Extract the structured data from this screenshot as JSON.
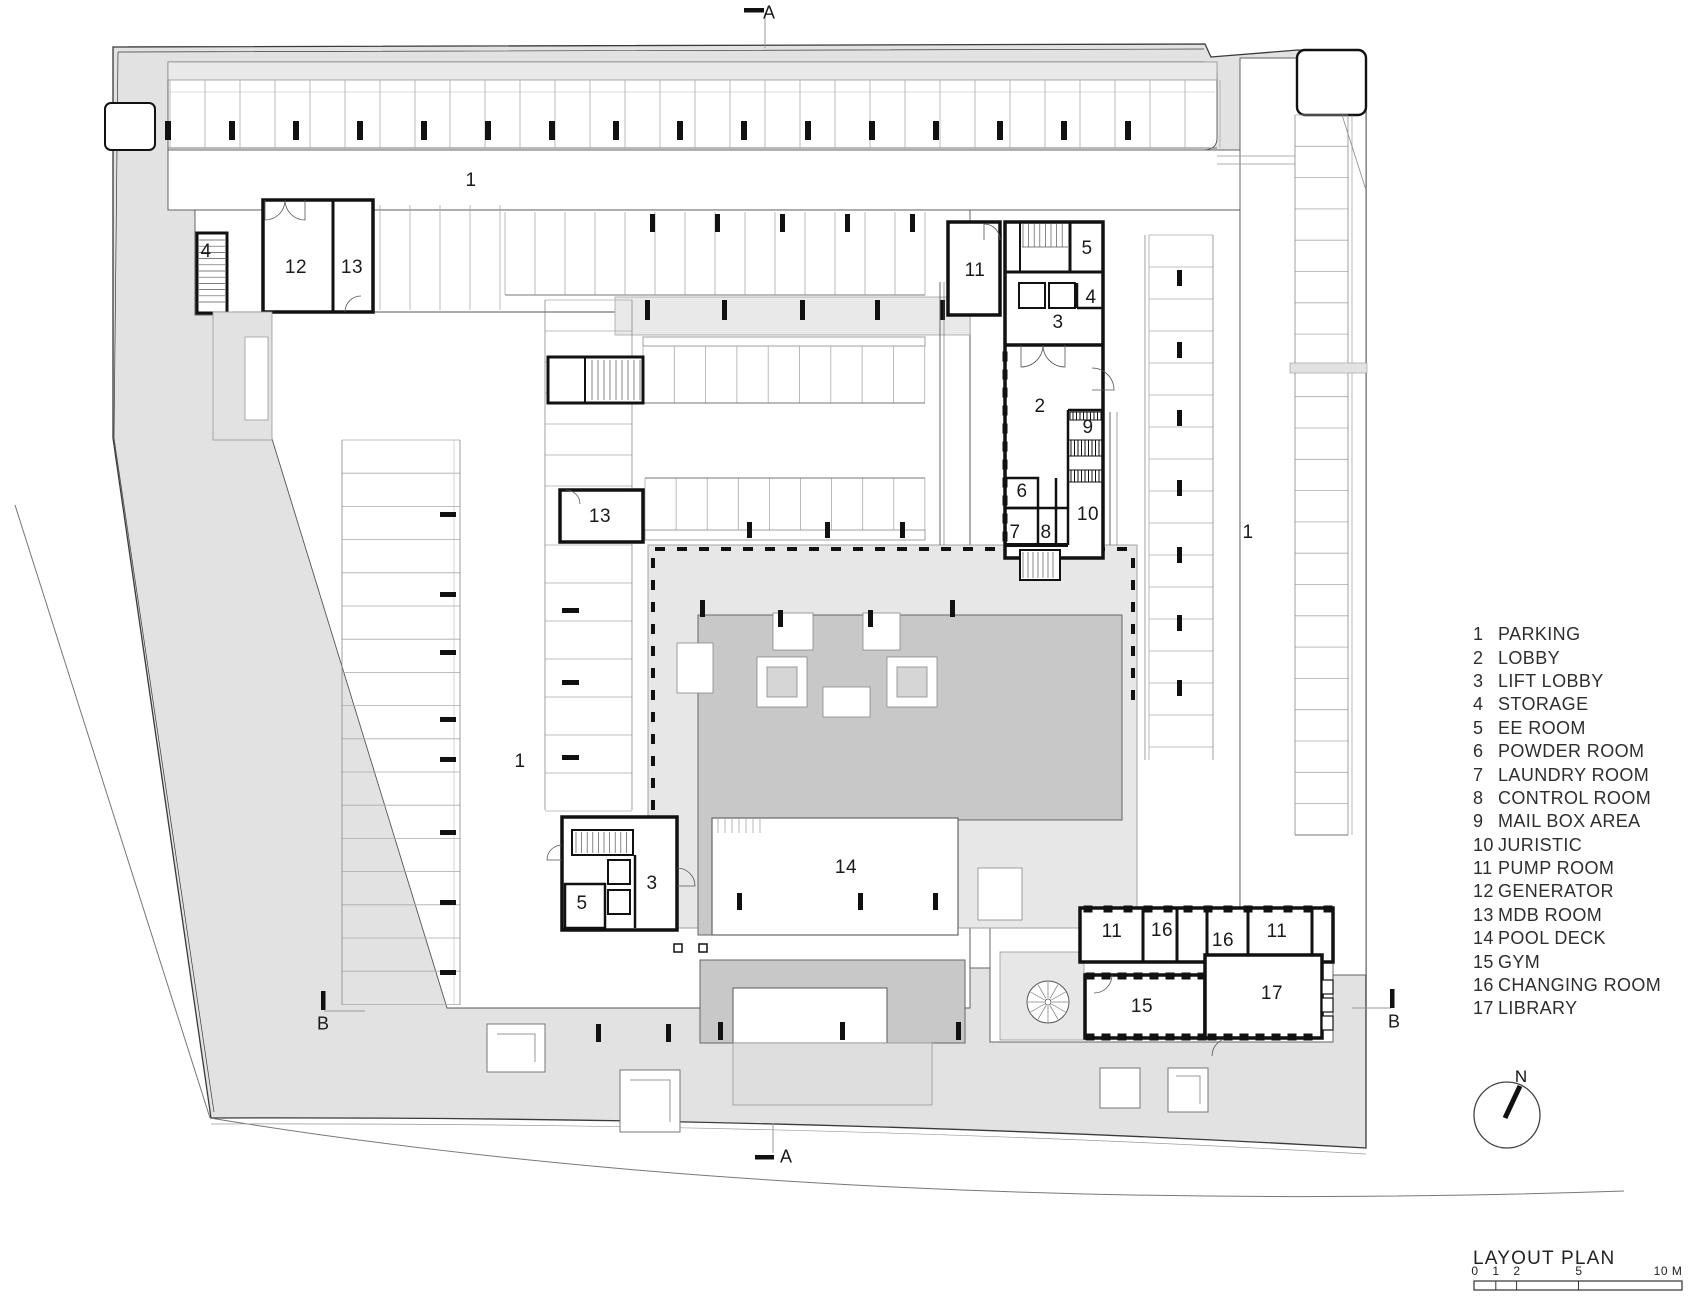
{
  "legend": {
    "items": [
      {
        "num": "1",
        "label": "PARKING"
      },
      {
        "num": "2",
        "label": "LOBBY"
      },
      {
        "num": "3",
        "label": "LIFT LOBBY"
      },
      {
        "num": "4",
        "label": "STORAGE"
      },
      {
        "num": "5",
        "label": "EE ROOM"
      },
      {
        "num": "6",
        "label": "POWDER ROOM"
      },
      {
        "num": "7",
        "label": "LAUNDRY ROOM"
      },
      {
        "num": "8",
        "label": "CONTROL ROOM"
      },
      {
        "num": "9",
        "label": "MAIL BOX AREA"
      },
      {
        "num": "10",
        "label": "JURISTIC"
      },
      {
        "num": "11",
        "label": "PUMP ROOM"
      },
      {
        "num": "12",
        "label": "GENERATOR"
      },
      {
        "num": "13",
        "label": "MDB ROOM"
      },
      {
        "num": "14",
        "label": "POOL DECK"
      },
      {
        "num": "15",
        "label": "GYM"
      },
      {
        "num": "16",
        "label": "CHANGING ROOM"
      },
      {
        "num": "17",
        "label": "LIBRARY"
      }
    ]
  },
  "plan_labels": [
    {
      "text": "1",
      "x": 471,
      "y": 181
    },
    {
      "text": "4",
      "x": 206,
      "y": 252
    },
    {
      "text": "12",
      "x": 296,
      "y": 268
    },
    {
      "text": "13",
      "x": 352,
      "y": 268
    },
    {
      "text": "11",
      "x": 975,
      "y": 271
    },
    {
      "text": "5",
      "x": 1087,
      "y": 249
    },
    {
      "text": "4",
      "x": 1091,
      "y": 298
    },
    {
      "text": "3",
      "x": 1058,
      "y": 323
    },
    {
      "text": "2",
      "x": 1040,
      "y": 407
    },
    {
      "text": "9",
      "x": 1088,
      "y": 428
    },
    {
      "text": "13",
      "x": 600,
      "y": 517
    },
    {
      "text": "6",
      "x": 1022,
      "y": 492
    },
    {
      "text": "10",
      "x": 1088,
      "y": 515
    },
    {
      "text": "7",
      "x": 1015,
      "y": 533
    },
    {
      "text": "8",
      "x": 1046,
      "y": 533
    },
    {
      "text": "1",
      "x": 1248,
      "y": 533
    },
    {
      "text": "1",
      "x": 520,
      "y": 762
    },
    {
      "text": "14",
      "x": 846,
      "y": 868
    },
    {
      "text": "5",
      "x": 582,
      "y": 904
    },
    {
      "text": "3",
      "x": 652,
      "y": 884
    },
    {
      "text": "11",
      "x": 1112,
      "y": 932
    },
    {
      "text": "16",
      "x": 1162,
      "y": 931
    },
    {
      "text": "16",
      "x": 1223,
      "y": 941
    },
    {
      "text": "11",
      "x": 1277,
      "y": 932
    },
    {
      "text": "15",
      "x": 1142,
      "y": 1007
    },
    {
      "text": "17",
      "x": 1272,
      "y": 994
    }
  ],
  "section_markers": [
    {
      "label": "A",
      "x": 769,
      "y": 13
    },
    {
      "label": "A",
      "x": 786,
      "y": 1157
    },
    {
      "label": "B",
      "x": 323,
      "y": 1024
    },
    {
      "label": "B",
      "x": 1394,
      "y": 1022
    }
  ],
  "north_label": "N",
  "titleblock": {
    "title": "LAYOUT PLAN",
    "scale_numbers": [
      {
        "text": "0",
        "x": 1475
      },
      {
        "text": "1",
        "x": 1496
      },
      {
        "text": "2",
        "x": 1517
      },
      {
        "text": "5",
        "x": 1579
      },
      {
        "text": "10 M",
        "x": 1668
      }
    ]
  },
  "colors": {
    "site_gray": "#e2e2e2",
    "terrace_gray": "#e7e7e7",
    "curb_gray": "#e9e9e9",
    "deck_gray": "#c8c8c8",
    "wall_black": "#111111"
  }
}
